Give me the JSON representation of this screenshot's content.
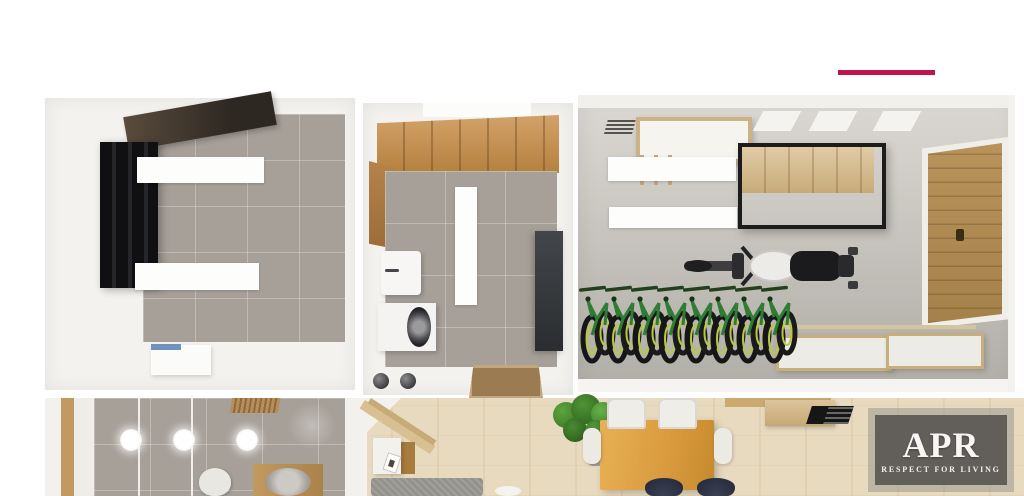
{
  "watermark": {
    "brand": "APR",
    "tagline": "RESPECT FOR LIVING"
  },
  "accent": {
    "underline_color": "#C2134E"
  },
  "scene": {
    "bicycle_count": 8,
    "ceiling_light_count": 3,
    "rooms": [
      {
        "id": "storage-room",
        "items": [
          "dark-ceiling-panel",
          "black-wardrobe",
          "white-wall-shelves",
          "storage-box"
        ]
      },
      {
        "id": "utility-room",
        "items": [
          "wood-loft-panel",
          "sink",
          "washing-machine",
          "tall-dark-cabinet",
          "doormat"
        ]
      },
      {
        "id": "garage",
        "items": [
          "vent-grille",
          "wall-shelf-unit",
          "suspended-wood-cabinet",
          "wooden-garage-door",
          "bicycle-rack",
          "motorcycle",
          "storage-benches"
        ]
      },
      {
        "id": "bathroom",
        "items": [
          "wood-door-frame",
          "ceiling-lights",
          "shower-glass-panels",
          "toilet",
          "wood-vanity",
          "round-basin",
          "wood-slat-mat"
        ]
      },
      {
        "id": "living-dining-room",
        "items": [
          "stair-trim",
          "side-table",
          "rug",
          "potted-plant",
          "dining-table",
          "white-chairs",
          "dark-chairs",
          "desk-shelf",
          "laptop"
        ]
      }
    ],
    "colors": {
      "tile_gray": "#A7A099",
      "wood_panel": "#C9955B",
      "light_wood_floor": "#E8DABF",
      "garage_door_wood": "#B28D52",
      "bicycle_green": "#2E7D32",
      "wheel_rim_yellow": "#B8C93C",
      "motorcycle_tank": "#ECEBE7"
    }
  }
}
